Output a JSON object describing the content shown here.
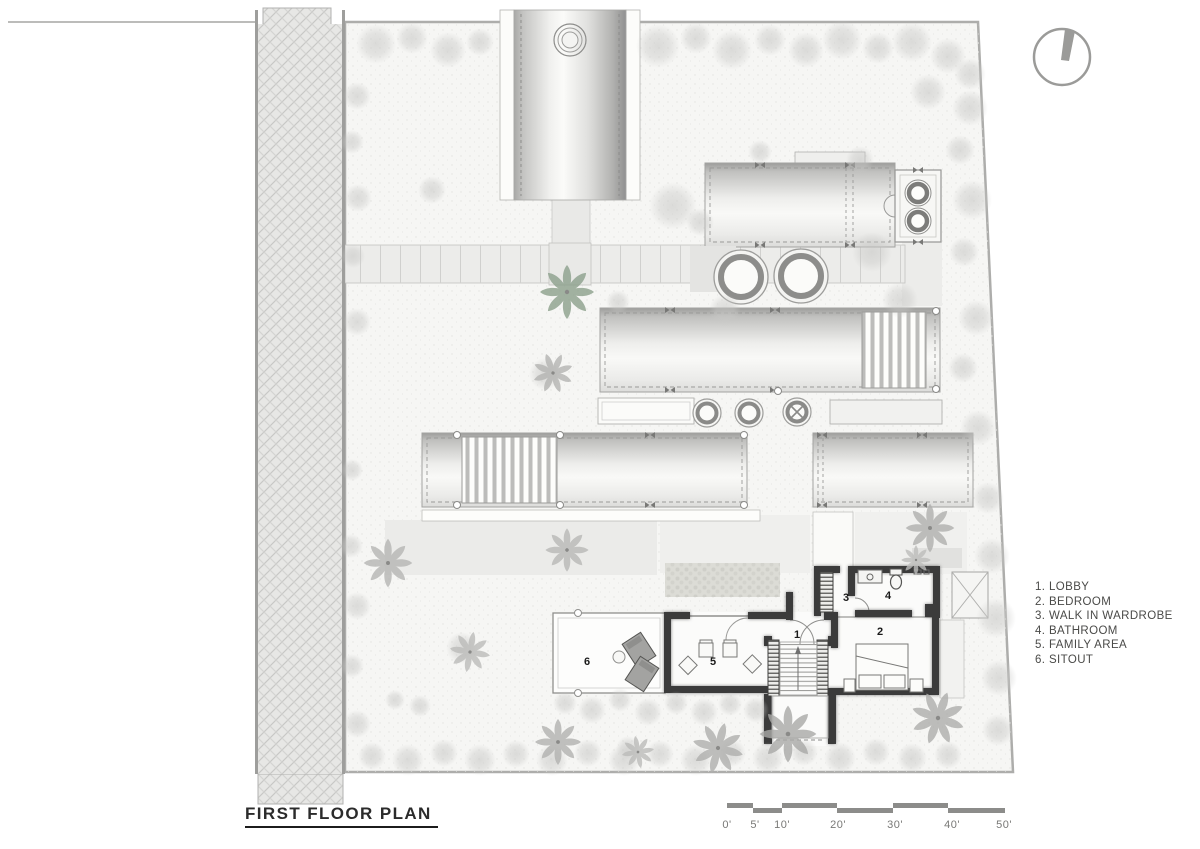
{
  "page": {
    "background": "#ffffff",
    "drawing_type": "architectural site / floor plan"
  },
  "title": {
    "text": "FIRST FLOOR PLAN"
  },
  "legend": {
    "items": [
      "1. LOBBY",
      "2. BEDROOM",
      "3. WALK IN WARDROBE",
      "4. BATHROOM",
      "5. FAMILY AREA",
      "6. SITOUT"
    ]
  },
  "plan": {
    "room_numbers": [
      "1",
      "2",
      "3",
      "4",
      "5",
      "6"
    ]
  },
  "scale_bar": {
    "labels": [
      "0'",
      "5'",
      "10'",
      "20'",
      "30'",
      "40'",
      "50'"
    ]
  },
  "icons": {
    "north": "north-arrow"
  },
  "colors": {
    "wall": "#3a3a3a",
    "roof_shade": "#9d9d9b",
    "site": "#f6f6f4",
    "road": "#e7e7e5",
    "scale_bar": "#8c8c8a",
    "tree": "#c6c6c4"
  }
}
